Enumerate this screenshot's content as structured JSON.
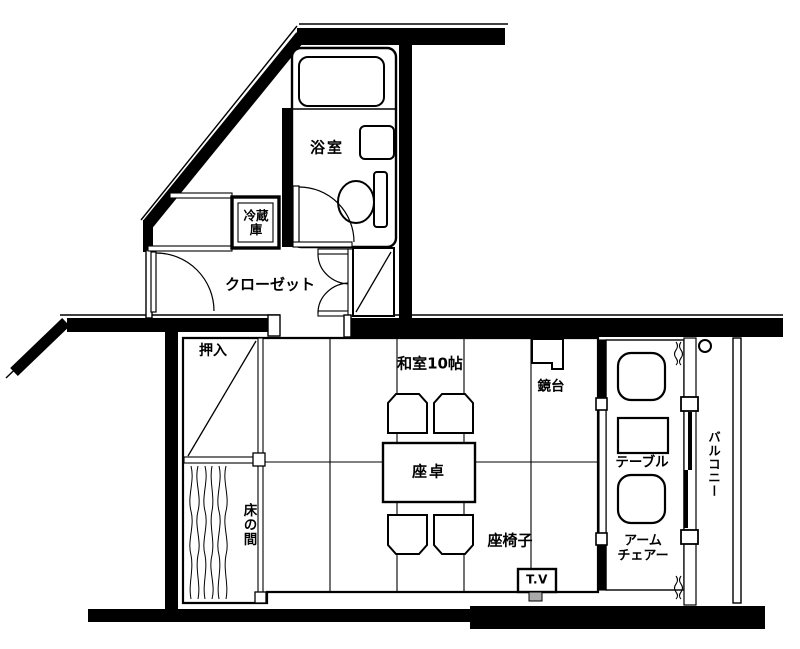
{
  "floorplan": {
    "title": "和室10帖 間取り図",
    "labels": {
      "bathroom": "浴室",
      "refrigerator_line1": "冷蔵",
      "refrigerator_line2": "庫",
      "closet": "クローゼット",
      "oshiire": "押入",
      "tokonoma": "床の間",
      "washitsu": "和室10帖",
      "mirror_stand": "鏡台",
      "low_table": "座卓",
      "floor_chair": "座椅子",
      "tv": "T.V",
      "side_table": "テーブル",
      "armchair_line1": "アーム",
      "armchair_line2": "チェアー",
      "balcony": "バルコニー"
    },
    "colors": {
      "wall": "#000000",
      "line": "#111111",
      "background": "#ffffff"
    }
  }
}
